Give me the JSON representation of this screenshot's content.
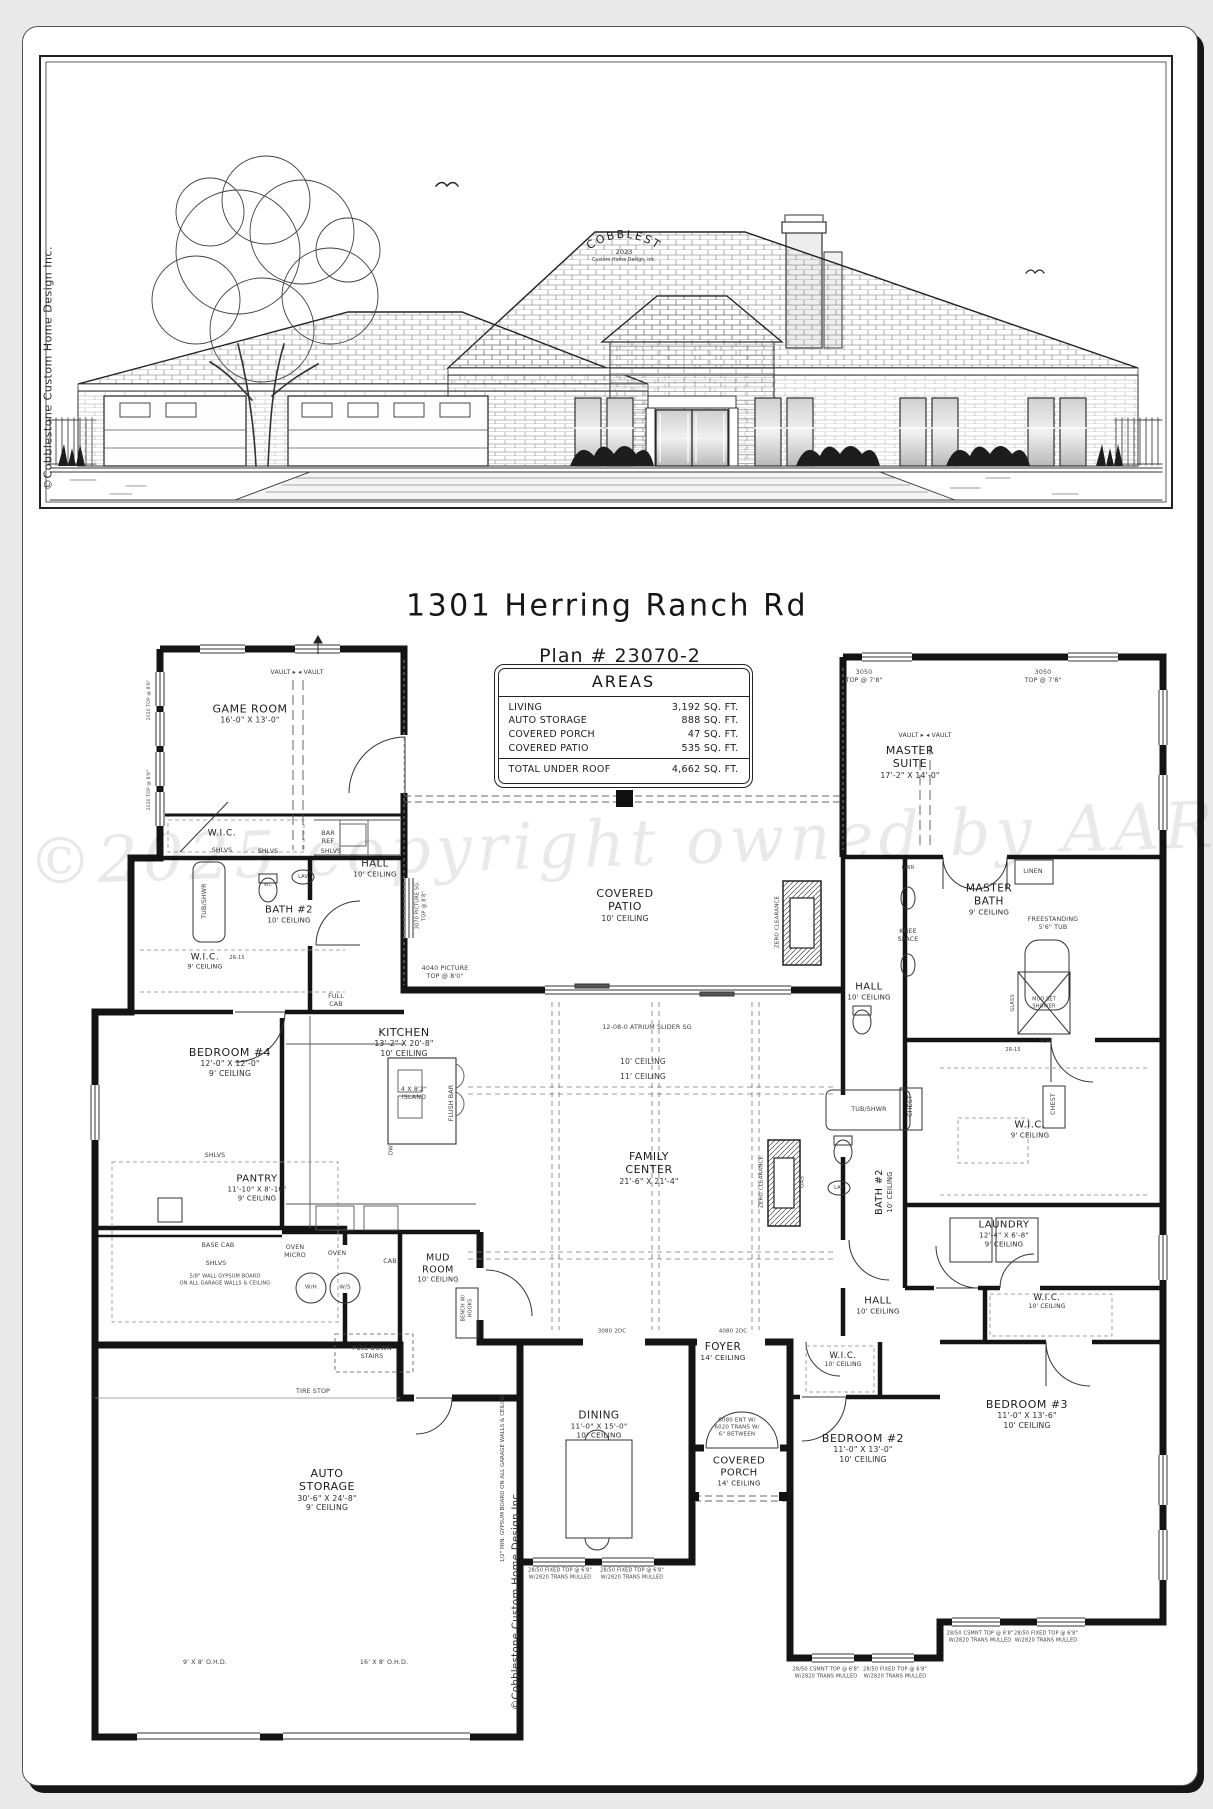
{
  "sheet": {
    "address": "1301 Herring Ranch Rd",
    "plan_number": "Plan # 23070-2"
  },
  "areas": {
    "title": "AREAS",
    "rows": [
      {
        "label": "LIVING",
        "value": "3,192 SQ. FT."
      },
      {
        "label": "AUTO STORAGE",
        "value": "888 SQ. FT."
      },
      {
        "label": "COVERED PORCH",
        "value": "47 SQ. FT."
      },
      {
        "label": "COVERED PATIO",
        "value": "535 SQ. FT."
      }
    ],
    "total_label": "TOTAL UNDER ROOF",
    "total_value": "4,662 SQ. FT."
  },
  "elevation": {
    "logo": "COBBLESTONE",
    "logo_year": "2023",
    "logo_sub": "Custom Home Design, Inc."
  },
  "watermark": "©2025 copyright owned by AAR",
  "margin_notes": {
    "left": "©Cobblestone Custom Home Design Inc.",
    "garage_side": "©Cobblestone Custom Home Design Inc.",
    "garage_gypsum": "1/2\" MIN. GYPSUM BOARD ON ALL GARAGE WALLS & CEILING"
  },
  "rooms": [
    {
      "nm": [
        "GAME ROOM"
      ],
      "sub": [
        "16'-0\" X 13'-0\""
      ],
      "x": 250,
      "y": 714
    },
    {
      "nm": [
        "W.I.C."
      ],
      "sub": [],
      "x": 222,
      "y": 834,
      "fs": 9
    },
    {
      "nm": [
        "HALL"
      ],
      "sub": [
        "10' CEILING"
      ],
      "x": 375,
      "y": 869,
      "fs": 10
    },
    {
      "nm": [
        "BATH #2"
      ],
      "sub": [
        "10' CEILING"
      ],
      "x": 289,
      "y": 915,
      "fs": 10
    },
    {
      "nm": [
        "W.I.C."
      ],
      "sub": [
        "9' CEILING"
      ],
      "x": 205,
      "y": 962,
      "fs": 9
    },
    {
      "nm": [
        "BEDROOM #4"
      ],
      "sub": [
        "12'-0\" X 12'-0\"",
        "9' CEILING"
      ],
      "x": 230,
      "y": 1062
    },
    {
      "nm": [
        "KITCHEN"
      ],
      "sub": [
        "13'-2\" X 20'-8\"",
        "10' CEILING"
      ],
      "x": 404,
      "y": 1042
    },
    {
      "nm": [
        "COVERED",
        "PATIO"
      ],
      "sub": [
        "10' CEILING"
      ],
      "x": 625,
      "y": 905
    },
    {
      "nm": [
        "MASTER",
        "SUITE"
      ],
      "sub": [
        "17'-2\" X 14'-0\""
      ],
      "x": 910,
      "y": 762
    },
    {
      "nm": [
        "MASTER",
        "BATH"
      ],
      "sub": [
        "9' CEILING"
      ],
      "x": 989,
      "y": 900,
      "fs": 10.5
    },
    {
      "nm": [
        "HALL"
      ],
      "sub": [
        "10' CEILING"
      ],
      "x": 869,
      "y": 992,
      "fs": 10
    },
    {
      "nm": [
        "FAMILY",
        "CENTER"
      ],
      "sub": [
        "21'-6\" X 21'-4\""
      ],
      "x": 649,
      "y": 1168
    },
    {
      "nm": [
        "W.I.C."
      ],
      "sub": [
        "9' CEILING"
      ],
      "x": 1030,
      "y": 1130,
      "fs": 10
    },
    {
      "nm": [
        "LAUNDRY"
      ],
      "sub": [
        "12'-4\" X 6'-8\"",
        "9' CEILING"
      ],
      "x": 1004,
      "y": 1234,
      "fs": 10
    },
    {
      "nm": [
        "BATH #2"
      ],
      "sub": [
        "10' CEILING"
      ],
      "x": 884,
      "y": 1192,
      "fs": 9.5,
      "rot": -90
    },
    {
      "nm": [
        "PANTRY"
      ],
      "sub": [
        "11'-10\" X 8'-10\"",
        "9' CEILING"
      ],
      "x": 257,
      "y": 1188,
      "fs": 10
    },
    {
      "nm": [
        "MUD",
        "ROOM"
      ],
      "sub": [
        "10' CEILING"
      ],
      "x": 438,
      "y": 1268,
      "fs": 9.5
    },
    {
      "nm": [
        "HALL"
      ],
      "sub": [
        "10' CEILING"
      ],
      "x": 878,
      "y": 1306,
      "fs": 10
    },
    {
      "nm": [
        "FOYER"
      ],
      "sub": [
        "14' CEILING"
      ],
      "x": 723,
      "y": 1352,
      "fs": 10.5
    },
    {
      "nm": [
        "DINING"
      ],
      "sub": [
        "11'-0\" X 15'-0\"",
        "10' CEILING"
      ],
      "x": 599,
      "y": 1425,
      "fs": 10.5
    },
    {
      "nm": [
        "COVERED",
        "PORCH"
      ],
      "sub": [
        "14' CEILING"
      ],
      "x": 739,
      "y": 1472,
      "fs": 10
    },
    {
      "nm": [
        "BEDROOM #2"
      ],
      "sub": [
        "11'-0\" X 13'-0\"",
        "10' CEILING"
      ],
      "x": 863,
      "y": 1448
    },
    {
      "nm": [
        "BEDROOM #3"
      ],
      "sub": [
        "11'-0\" X 13'-6\"",
        "10' CEILING"
      ],
      "x": 1027,
      "y": 1414
    },
    {
      "nm": [
        "W.I.C."
      ],
      "sub": [
        "10' CEILING"
      ],
      "x": 843,
      "y": 1360,
      "fs": 8.5
    },
    {
      "nm": [
        "W.I.C."
      ],
      "sub": [
        "10' CEILING"
      ],
      "x": 1047,
      "y": 1302,
      "fs": 8.5
    },
    {
      "nm": [
        "AUTO",
        "STORAGE"
      ],
      "sub": [
        "30'-6\" X 24'-8\"",
        "9' CEILING"
      ],
      "x": 327,
      "y": 1490
    }
  ],
  "notes": [
    {
      "t": [
        "VAULT ▸    ◂ VAULT"
      ],
      "x": 297,
      "y": 673
    },
    {
      "t": [
        "VAULT ▸    ◂ VAULT"
      ],
      "x": 925,
      "y": 736
    },
    {
      "t": [
        "BAR",
        "REF"
      ],
      "x": 328,
      "y": 838
    },
    {
      "t": [
        "SHLVS"
      ],
      "x": 222,
      "y": 851
    },
    {
      "t": [
        "SHLVS"
      ],
      "x": 268,
      "y": 852
    },
    {
      "t": [
        "SHLVS"
      ],
      "x": 331,
      "y": 852
    },
    {
      "t": [
        "SHLVS"
      ],
      "x": 215,
      "y": 1156
    },
    {
      "t": [
        "BASE CAB"
      ],
      "x": 218,
      "y": 1246
    },
    {
      "t": [
        "SHLVS"
      ],
      "x": 216,
      "y": 1264
    },
    {
      "t": [
        "OVEN",
        "MICRO"
      ],
      "x": 295,
      "y": 1252
    },
    {
      "t": [
        "OVEN"
      ],
      "x": 337,
      "y": 1254
    },
    {
      "t": [
        "CAB"
      ],
      "x": 390,
      "y": 1262
    },
    {
      "t": [
        "W/H"
      ],
      "x": 311,
      "y": 1288,
      "fs": 5.5
    },
    {
      "t": [
        "W/S"
      ],
      "x": 345,
      "y": 1288,
      "fs": 5.5
    },
    {
      "t": [
        "PULL DOWN",
        "STAIRS"
      ],
      "x": 372,
      "y": 1353
    },
    {
      "t": [
        "TIRE STOP"
      ],
      "x": 313,
      "y": 1392
    },
    {
      "t": [
        "9' X 8' O.H.D."
      ],
      "x": 205,
      "y": 1663
    },
    {
      "t": [
        "16' X 8' O.H.D."
      ],
      "x": 384,
      "y": 1663
    },
    {
      "t": [
        "FULL",
        "CAB"
      ],
      "x": 336,
      "y": 1001
    },
    {
      "t": [
        "4 X 8'2\"",
        "ISLAND"
      ],
      "x": 414,
      "y": 1094
    },
    {
      "t": [
        "FLUSH BAR"
      ],
      "x": 452,
      "y": 1103,
      "rot": -90
    },
    {
      "t": [
        "DW"
      ],
      "x": 392,
      "y": 1150,
      "rot": -90,
      "fs": 5.5
    },
    {
      "t": [
        "TUB/SHWR"
      ],
      "x": 869,
      "y": 1110
    },
    {
      "t": [
        "TUB/SHWR"
      ],
      "x": 205,
      "y": 901,
      "rot": -90
    },
    {
      "t": [
        "LINEN"
      ],
      "x": 1033,
      "y": 872
    },
    {
      "t": [
        "KNEE",
        "SPACE"
      ],
      "x": 908,
      "y": 936
    },
    {
      "t": [
        "FREESTANDING",
        "5'6\" TUB"
      ],
      "x": 1053,
      "y": 924
    },
    {
      "t": [
        "CHEST"
      ],
      "x": 911,
      "y": 1106,
      "rot": -90
    },
    {
      "t": [
        "CHEST"
      ],
      "x": 1054,
      "y": 1104,
      "rot": -90
    },
    {
      "t": [
        "SEAT"
      ],
      "x": 1046,
      "y": 1042,
      "fs": 5.5
    },
    {
      "t": [
        "MUD SET",
        "SHOWER"
      ],
      "x": 1044,
      "y": 1003,
      "fs": 5
    },
    {
      "t": [
        "GLASS"
      ],
      "x": 1013,
      "y": 1003,
      "rot": -90,
      "fs": 5
    },
    {
      "t": [
        "ZERO CLEARANCE"
      ],
      "x": 778,
      "y": 922,
      "rot": -90,
      "fs": 5.5
    },
    {
      "t": [
        "ZERO CLEARANCE"
      ],
      "x": 762,
      "y": 1182,
      "rot": -90,
      "fs": 5.5
    },
    {
      "t": [
        "GAS"
      ],
      "x": 803,
      "y": 1182,
      "rot": -90,
      "fs": 5.5
    },
    {
      "t": [
        "12-08-0 ATRIUM SLIDER SG"
      ],
      "x": 647,
      "y": 1028
    },
    {
      "t": [
        "10' CEILING"
      ],
      "x": 643,
      "y": 1062,
      "fs": 7.5
    },
    {
      "t": [
        "11' CEILING"
      ],
      "x": 643,
      "y": 1077,
      "fs": 7.5
    },
    {
      "t": [
        "3050",
        "TOP @ 7'8\""
      ],
      "x": 864,
      "y": 677
    },
    {
      "t": [
        "3050",
        "TOP @ 7'8\""
      ],
      "x": 1043,
      "y": 677
    },
    {
      "t": [
        "2020 TOP @ 8'6\""
      ],
      "x": 150,
      "y": 700,
      "rot": -90,
      "fs": 4.5
    },
    {
      "t": [
        "2020 TOP @ 8'6\""
      ],
      "x": 150,
      "y": 790,
      "rot": -90,
      "fs": 4.5
    },
    {
      "t": [
        "4040 PICTURE",
        "TOP @ 8'0\""
      ],
      "x": 445,
      "y": 973
    },
    {
      "t": [
        "3070 PICTURE SG",
        "TOP @ 8'8\""
      ],
      "x": 421,
      "y": 906,
      "rot": -90,
      "fs": 5
    },
    {
      "t": [
        "6080 ENT W/",
        "6020 TRANS W/",
        "6\" BETWEEN"
      ],
      "x": 737,
      "y": 1428,
      "fs": 5.5
    },
    {
      "t": [
        "3080 2DC"
      ],
      "x": 612,
      "y": 1332,
      "fs": 5.5
    },
    {
      "t": [
        "4080 2DC"
      ],
      "x": 733,
      "y": 1332,
      "fs": 5.5
    },
    {
      "t": [
        "BENCH W/",
        "HOOKS"
      ],
      "x": 467,
      "y": 1308,
      "rot": -90,
      "fs": 5
    },
    {
      "t": [
        "5/8\" WALL GYPSUM BOARD",
        "ON ALL GARAGE WALLS & CEILING"
      ],
      "x": 225,
      "y": 1280,
      "fs": 5
    },
    {
      "t": [
        "2R-15"
      ],
      "x": 237,
      "y": 958,
      "fs": 5
    },
    {
      "t": [
        "2R-15"
      ],
      "x": 1013,
      "y": 1050,
      "fs": 5
    },
    {
      "t": [
        "DWR"
      ],
      "x": 908,
      "y": 868,
      "fs": 5
    },
    {
      "t": [
        "LAV"
      ],
      "x": 303,
      "y": 877,
      "fs": 5
    },
    {
      "t": [
        "WC"
      ],
      "x": 268,
      "y": 886,
      "fs": 4.5
    },
    {
      "t": [
        "LAV"
      ],
      "x": 839,
      "y": 1188,
      "fs": 5
    },
    {
      "t": [
        "28/50 FIXED TOP @ 6'8\"",
        "W/2820 TRANS MULLED"
      ],
      "x": 560,
      "y": 1574,
      "fs": 5
    },
    {
      "t": [
        "28/50 FIXED TOP @ 6'8\"",
        "W/2820 TRANS MULLED"
      ],
      "x": 632,
      "y": 1574,
      "fs": 5
    },
    {
      "t": [
        "28/50 CSMNT TOP @ 6'8\"",
        "W/2820 TRANS MULLED"
      ],
      "x": 826,
      "y": 1673,
      "fs": 5
    },
    {
      "t": [
        "28/50 FIXED TOP @ 6'8\"",
        "W/2820 TRANS MULLED"
      ],
      "x": 895,
      "y": 1673,
      "fs": 5
    },
    {
      "t": [
        "28/50 CSMNT TOP @ 6'8\"",
        "W/2820 TRANS MULLED"
      ],
      "x": 980,
      "y": 1637,
      "fs": 5
    },
    {
      "t": [
        "28/50 FIXED TOP @ 6'8\"",
        "W/2820 TRANS MULLED"
      ],
      "x": 1046,
      "y": 1637,
      "fs": 5
    }
  ]
}
